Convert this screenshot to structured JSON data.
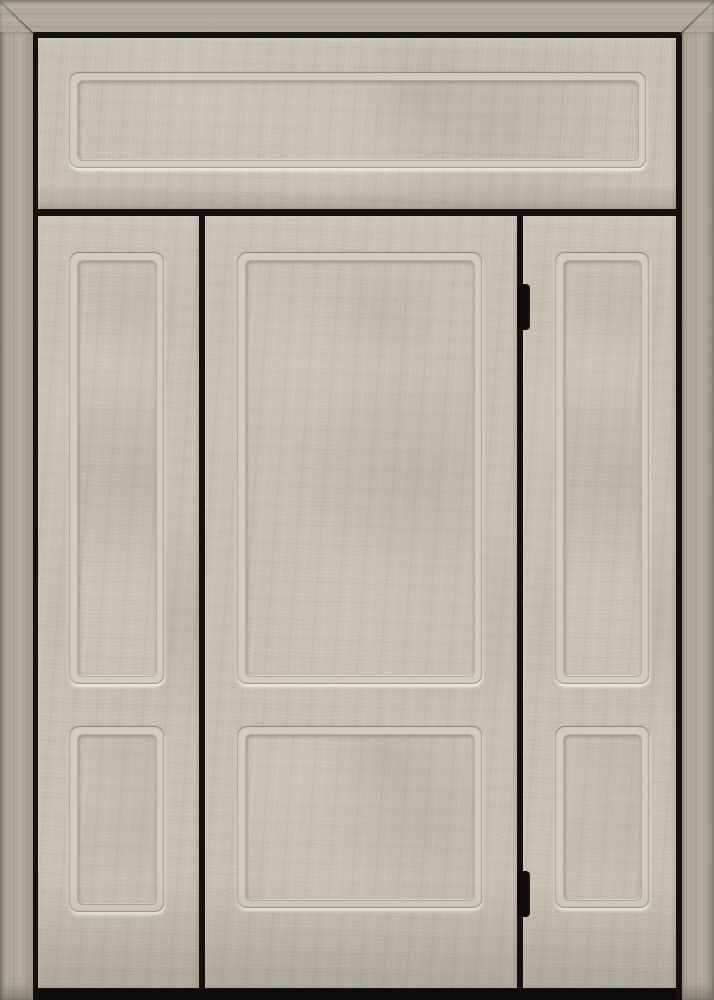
{
  "meta": {
    "kind": "product-photo",
    "subject": "Front entry door unit, beige concrete-textured finish"
  },
  "theme": {
    "door_base": "#c6c0b2",
    "door_light": "#d2ccbe",
    "frame_base": "#b1ab9e",
    "groove_dark": "#7f7a6e",
    "groove_light": "#e8e2d4",
    "reveal_black": "#131211",
    "hinge_black": "#0c0b0a",
    "threshold_black": "#0b0b0a"
  },
  "unit": {
    "label": "Entry door unit with transom and two sidelights, beige stone-textured finish, black frame reveals",
    "frame": {
      "label": "Outer textured frame with mitered top corners"
    },
    "transom": {
      "label": "Full-width transom with one recessed rectangular panel",
      "panel_count": 1
    },
    "left_sidelight": {
      "label": "Left sidelight with two recessed panels",
      "panel_count": 2
    },
    "door": {
      "label": "Center door slab with two recessed panels, hinged on right, no handle visible",
      "panel_count": 2,
      "hinge_count": 2,
      "hinge_side": "right"
    },
    "right_sidelight": {
      "label": "Right sidelight with two recessed panels",
      "panel_count": 2
    },
    "hinges": {
      "top": {
        "label": "Top door hinge, black"
      },
      "bottom": {
        "label": "Bottom door hinge, black"
      }
    },
    "threshold": {
      "label": "Dark threshold strip at base of unit"
    }
  }
}
